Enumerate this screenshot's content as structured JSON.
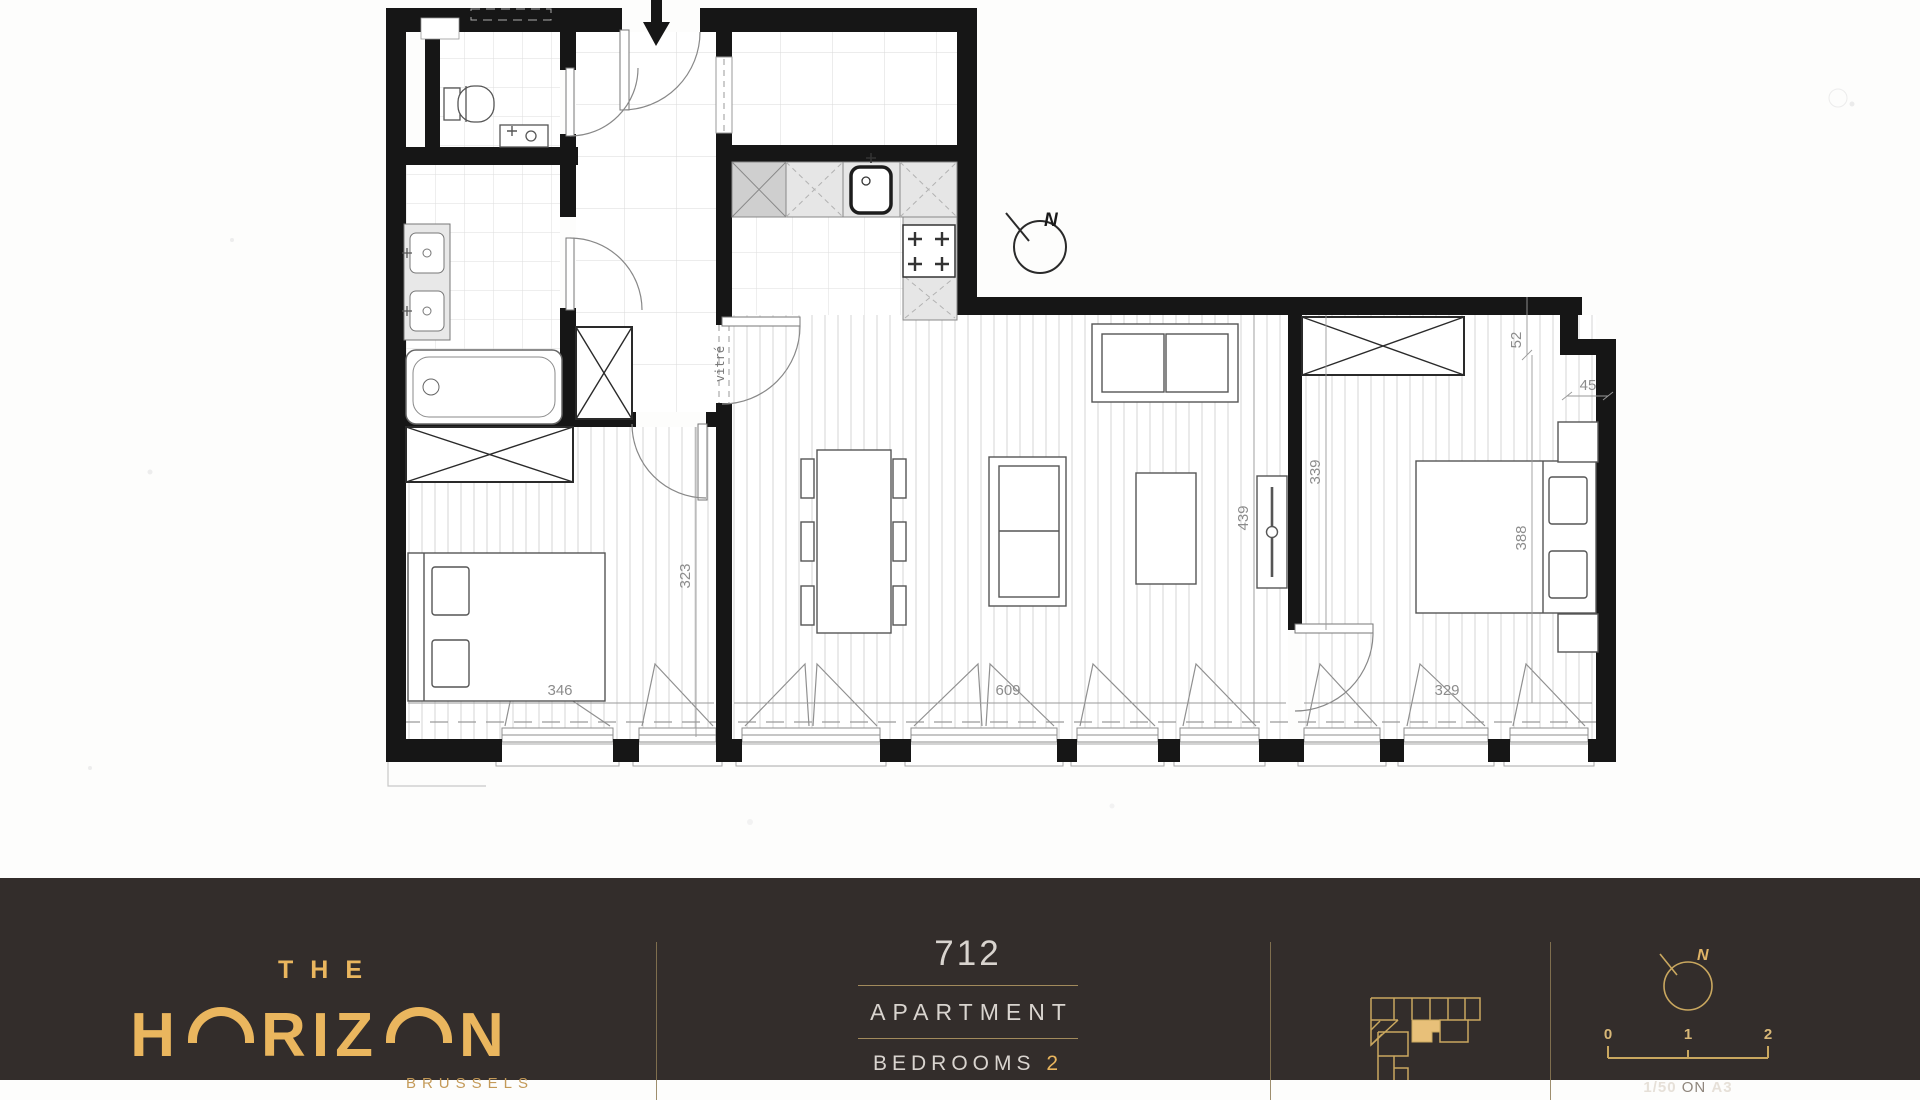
{
  "plan": {
    "dimensions": {
      "bedroom1_width": "346",
      "living_width": "609",
      "bedroom2_width": "329",
      "bedroom1_depth": "323",
      "living_depth": "439",
      "bedroom2_depth": "339",
      "bed_wall": "388",
      "step_height": "52",
      "step_width": "45"
    },
    "labels": {
      "glazed_door": "vitré",
      "north": "N"
    }
  },
  "footer": {
    "brand": {
      "line1": "THE",
      "letters": [
        "H",
        "R",
        "I",
        "Z",
        "N"
      ],
      "city": "BRUSSELS"
    },
    "unit": {
      "number": "712",
      "type": "APARTMENT",
      "bedrooms_label": "BEDROOMS",
      "bedrooms_value": "2"
    },
    "compass": {
      "label": "N"
    },
    "scalebar": {
      "ticks": [
        "0",
        "1",
        "2"
      ],
      "ratio": "1/50",
      "conjunction": "ON",
      "paper": "A3"
    },
    "colors": {
      "footer_background": "#332d2b",
      "gold": "#eab65e",
      "rule_gold": "#a28a5c",
      "light_text": "#d9d4cf",
      "wall_black": "#161616",
      "dimension_gray": "#8c8c8c"
    }
  }
}
